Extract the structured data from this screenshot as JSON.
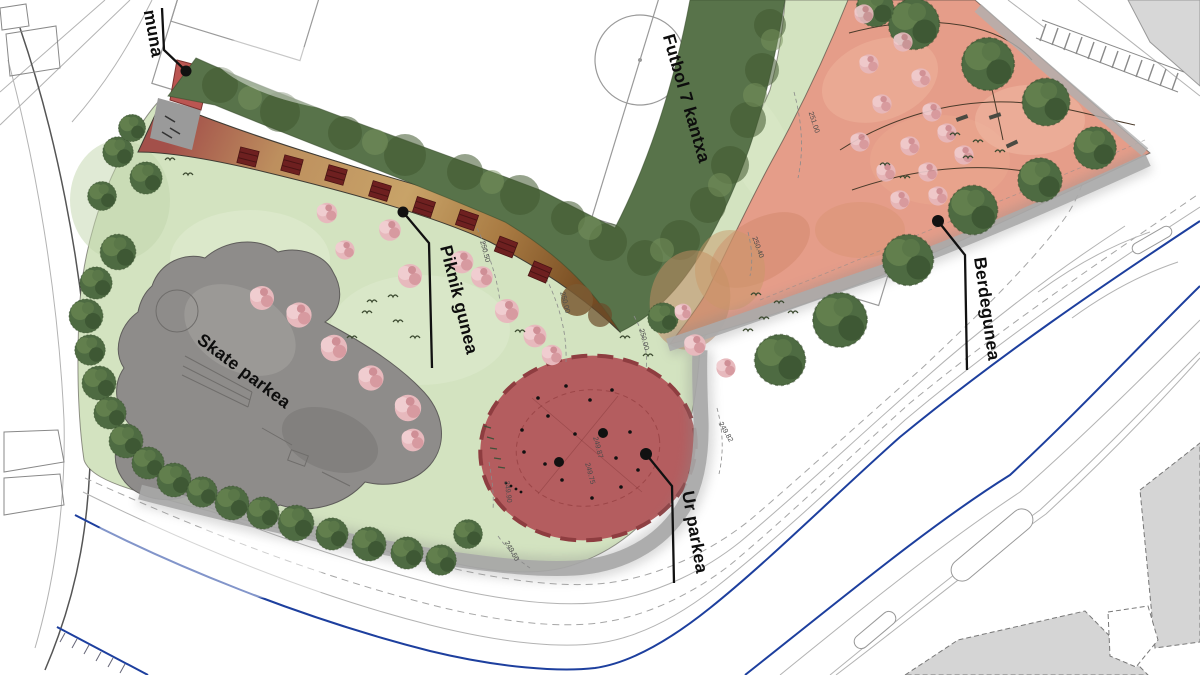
{
  "plan": {
    "labels": {
      "toilet_partial": "muna",
      "football_field": "Futbol 7 kantxa",
      "picnic_area": "Piknik gunea",
      "skate_park": "Skate parkea",
      "water_park": "Ur parkea",
      "green_zone": "Berdegunea"
    },
    "elevations": {
      "e251_00": "251.00",
      "e250_50": "250.50",
      "e250_40": "250.40",
      "e250_00_a": "250.00",
      "e250_00_b": "250.00",
      "e249_87": "249.87",
      "e249_75": "249.75",
      "e249_82": "249.82",
      "e249_90": "249.90",
      "e249_50": "249.50"
    },
    "colors": {
      "grass": "#d3e3c0",
      "hedge": "#58734a",
      "tree": "#4e6b42",
      "blossom": "#e7b9bd",
      "picnic_tan": "#c09a64",
      "picnic_red": "#a3504a",
      "skate_gray": "#8e8c8a",
      "water_park_red": "#b45d5f",
      "green_zone_pink": "#e59d89",
      "sidewalk_gray": "#a7a7a7",
      "boundary_blue": "#1d3f9e",
      "picnic_table": "#6e2020"
    }
  }
}
